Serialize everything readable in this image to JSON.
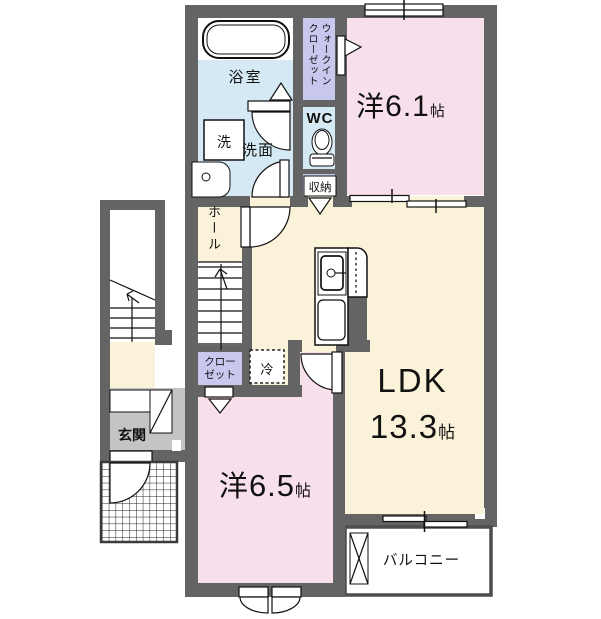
{
  "plan_title": "2F apartment floor plan",
  "rooms": {
    "western_room_1": {
      "name": "洋",
      "size": "6.1",
      "unit": "帖"
    },
    "western_room_2": {
      "name": "洋",
      "size": "6.5",
      "unit": "帖"
    },
    "ldk": {
      "name": "LDK",
      "size": "13.3",
      "unit": "帖"
    },
    "bathroom": {
      "label": "浴室"
    },
    "washroom": {
      "label": "洗面"
    },
    "washer_pan": {
      "label": "洗"
    },
    "toilet": {
      "label": "WC"
    },
    "walk_in_closet": {
      "label_line1": "ウォークイン",
      "label_line2": "クローゼット"
    },
    "storage": {
      "label": "収納"
    },
    "hall": {
      "label": "ホール"
    },
    "closet": {
      "label_line1": "クロー",
      "label_line2": "ゼット"
    },
    "refrigerator": {
      "label": "冷"
    },
    "entrance": {
      "label": "玄関"
    },
    "balcony": {
      "label": "バルコニー"
    }
  },
  "fixtures": [
    "bathtub",
    "toilet",
    "kitchen-sink",
    "kitchen-cabinet",
    "vanity-basin",
    "washer-pan",
    "refrigerator-space",
    "internal-staircase",
    "external-staircase",
    "entrance-porch-grid",
    "balcony-utility-box",
    "door-swing-arcs",
    "sliding-windows",
    "double-casement-window"
  ],
  "colors": {
    "wall": "#646464",
    "western_room_pink": "#f8dfec",
    "ldk_cream": "#faf3da",
    "wet_area_blue": "#d5e9f4",
    "closet_lavender": "#c8c7ed",
    "entrance_gray": "#c4c4c4",
    "balcony_border": "#4d4d4d"
  }
}
